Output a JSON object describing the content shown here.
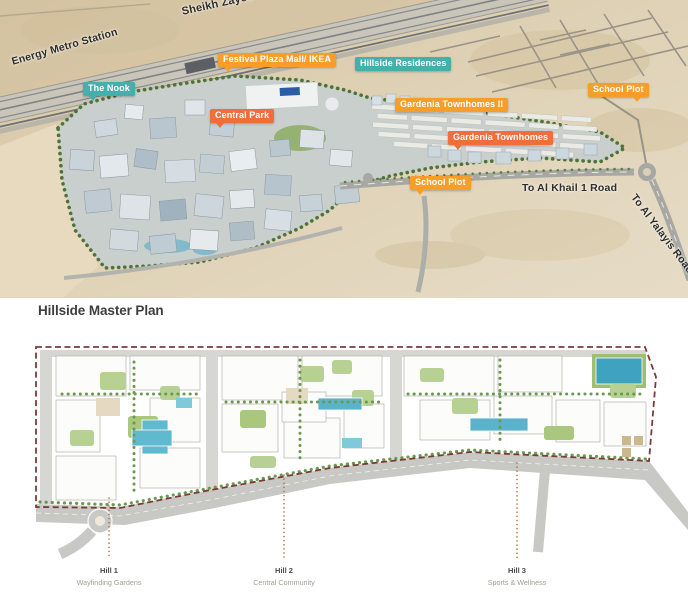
{
  "aerial": {
    "rotated_labels": {
      "sheikh_zayed": "Sheikh Zayed Road",
      "energy_metro": "Energy Metro Station",
      "al_khail": "To Al Khail 1 Road",
      "al_yalayis": "To Al Yalayis Road"
    },
    "badges": [
      {
        "label": "The Nook",
        "style": "teal"
      },
      {
        "label": "Festival Plaza Mall/ IKEA",
        "style": "orange"
      },
      {
        "label": "Hillside Residences",
        "style": "teal"
      },
      {
        "label": "Central Park",
        "style": "deep-orange"
      },
      {
        "label": "Gardenia Townhomes II",
        "style": "orange"
      },
      {
        "label": "Gardenia Townhomes",
        "style": "deep-orange"
      },
      {
        "label": "School Plot",
        "style": "orange"
      },
      {
        "label": "School Plot",
        "style": "orange"
      }
    ]
  },
  "master_plan": {
    "title": "Hillside Master Plan",
    "hills": [
      {
        "name": "Hill 1",
        "subtitle": "Wayfinding Gardens"
      },
      {
        "name": "Hill 2",
        "subtitle": "Central Community"
      },
      {
        "name": "Hill 3",
        "subtitle": "Sports & Wellness"
      }
    ]
  },
  "colors": {
    "badge_teal": "#43b0ab",
    "badge_orange": "#f89d28",
    "badge_deep_orange": "#ef6e3b",
    "boundary_dash": "#7b3c38",
    "leader_dots": "#b5714a",
    "desert": "#dcccab",
    "pool_blue": "#5ab3cb"
  }
}
